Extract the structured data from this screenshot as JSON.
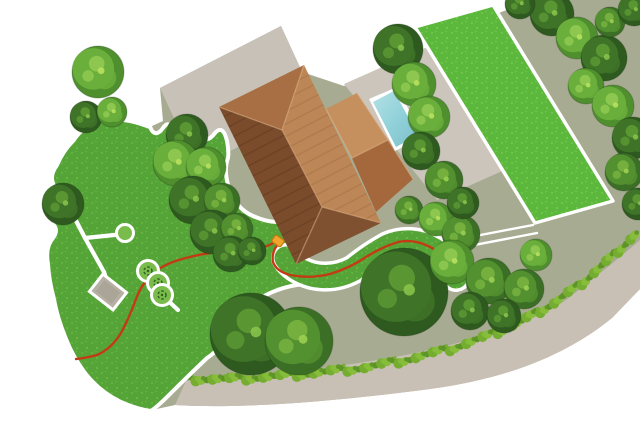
{
  "scene": {
    "kind": "garden-property-plan",
    "width": 640,
    "height": 427,
    "colors": {
      "background": "#ffffff",
      "ground": "#a7ab91",
      "road": "#c9c0b5",
      "driveway": "#c7c1b7",
      "patio": "#ccc5bb",
      "lawn": "#55a438",
      "lawn_dot1": "#70bb4c",
      "lawn_dot2": "#82c957",
      "rect_lawn": "#5cb83c",
      "rect_lawn_dot1": "#79d051",
      "rect_lawn_dot2": "#90dd63",
      "border": "#ffffff",
      "wire": "#c43a12",
      "station": "#f2a32d",
      "station_edge": "#c27b10",
      "pad": "#b6afa3",
      "pad_inner": "#a9a295",
      "bush_fill": "#7abc4b",
      "bush_mark": "#2f6021",
      "hedge": [
        "#5d9426",
        "#74ad30",
        "#86bd3a"
      ],
      "pool_frame": "#ffffff",
      "pool_water_light": "#b3e1e6",
      "pool_water_mid": "#8fd0d8",
      "pool_water_deep": "#7dbfca",
      "ridge_line": "#e0b488"
    },
    "tree_tones": {
      "dark": {
        "base": "#2e5a20",
        "mid": "#3f7428",
        "hi": "#5d9a33",
        "glow": "#86c24a"
      },
      "mid": {
        "base": "#3c6f26",
        "mid": "#539030",
        "hi": "#79b440",
        "glow": "#9ccf52"
      },
      "light": {
        "base": "#4f8f2e",
        "mid": "#6aaf3c",
        "hi": "#92ca52",
        "glow": "#b8e05e"
      }
    },
    "geometry": {
      "ground": "M 152 126 L 200 250 L 207 355 L 152 410 L 175 405 C 240 409 330 402 430 389 C 520 377 575 348 612 318 L 640 289 L 640 0 L 545 0 C 515 6 490 14 465 30 L 452 38 L 344 86 L 302 72 L 281 26 L 160 88 L 163 121 Z",
      "road": "M 175 405 C 240 409 330 402 430 389 C 520 377 575 348 612 318 L 640 289 L 640 240 C 622 256 600 273 570 297 C 536 323 470 341 420 352 C 350 367 260 376 186 381 Z",
      "driveway": "160,88 281,26 318,106 197,168",
      "patio": "344,84 452,36 545,152 437,200",
      "rect_lawn": "415,27 493,5 613,201 535,223",
      "left_lawn": "M 150 127 Q 155 139 163 128 Q 169 119 175 132 Q 180 143 188 130 Q 194 121 201 134 Q 206 145 215 133 Q 223 124 227 141 Q 229 152 228 158 Q 223 172 230 191 Q 237 209 253 216 Q 267 222 277 222 Q 288 225 290 237 Q 291 247 289 252 Q 288 261 298 268 Q 310 276 324 277 Q 338 280 341 287 Q 330 284 307 284 Q 286 285 266 295 Q 251 303 242 315 Q 235 327 225 341 Q 215 353 207 358 Q 186 378 168 396 Q 158 406 151 411 Q 136 409 119 401 Q 99 391 85 373 Q 73 357 66 339 Q 57 317 54 299 Q 49 281 48 264 Q 45 247 53 238 Q 60 229 50 221 Q 43 213 53 203 Q 60 196 55 187 Q 48 177 57 165 Q 63 151 73 141 Q 81 129 93 123 Q 105 117 117 119 Q 133 121 141 124 Z",
      "strip": "M 286 258 Q 294 270 312 275 Q 334 280 354 269 Q 370 256 388 246 Q 404 239 422 244 Q 438 250 448 261 Q 455 269 456 277",
      "wire_left": "M 277 241 Q 258 252 238 252 Q 212 251 190 257 Q 167 262 153 273 Q 142 283 136 299 Q 130 316 121 333 Q 111 349 97 355 Q 86 358 76 359",
      "wire_right": "M 279 243 Q 271 252 273 262 Q 276 271 290 275 Q 310 279 330 274 Q 350 268 366 257 Q 382 247 398 242 Q 414 239 428 246 Q 441 252 449 262 Q 455 269 456 277",
      "walkway": [
        [
          423,
          246,
          533,
          225
        ],
        [
          427,
          254,
          537,
          233
        ]
      ],
      "garden_paths": [
        [
          85,
          238,
          124,
          234
        ],
        [
          85,
          238,
          104,
          272
        ],
        [
          85,
          238,
          72,
          213
        ],
        [
          104,
          272,
          107,
          281
        ],
        [
          162,
          295,
          178,
          310
        ]
      ],
      "pad": {
        "cx": 108,
        "cy": 292,
        "w": 30,
        "h": 22,
        "angle": 38
      },
      "feature_circle": {
        "cx": 125,
        "cy": 233,
        "r": 8.5
      },
      "bushes": [
        [
          148,
          271,
          10.5
        ],
        [
          158,
          283,
          10.5
        ],
        [
          162,
          295,
          10.5
        ]
      ],
      "station": {
        "cx": 278,
        "cy": 241,
        "w": 11,
        "h": 8,
        "angle": 35
      },
      "pool_frame": "369,99 397,87 423,137 395,151",
      "pool_water": "373,102 394,91 418,135 396,147",
      "hedge_line": [
        [
          190,
          379
        ],
        [
          235,
          379
        ],
        [
          280,
          376
        ],
        [
          325,
          372
        ],
        [
          370,
          367
        ],
        [
          410,
          359
        ],
        [
          450,
          349
        ],
        [
          488,
          336
        ],
        [
          522,
          321
        ],
        [
          554,
          303
        ],
        [
          582,
          283
        ],
        [
          606,
          262
        ],
        [
          626,
          243
        ],
        [
          639,
          231
        ]
      ],
      "house_planes": [
        {
          "pts": "219,107 304,65 282,130",
          "fill": "#a96f44",
          "name": "roof-north-face"
        },
        {
          "pts": "304,65 381,223 322,207 282,130",
          "fill": "#bd8656",
          "name": "roof-east-face"
        },
        {
          "pts": "381,223 296,264 322,207",
          "fill": "#7f5130",
          "name": "roof-south-face"
        },
        {
          "pts": "296,264 219,107 282,130 322,207",
          "fill": "#7a4c2c",
          "name": "roof-west-face"
        },
        {
          "pts": "326,109 357,93 388,140 352,158",
          "fill": "#c68f5e",
          "name": "wing-north-face"
        },
        {
          "pts": "357,93 413,179 388,140",
          "fill": "#b57b4a",
          "name": "wing-end-face"
        },
        {
          "pts": "413,179 376,212 352,158 388,140",
          "fill": "#a4683c",
          "name": "wing-south-face"
        }
      ],
      "house_ridges": [
        [
          219,
          107,
          282,
          130
        ],
        [
          304,
          65,
          282,
          130
        ],
        [
          381,
          223,
          322,
          207
        ],
        [
          296,
          264,
          322,
          207
        ],
        [
          282,
          130,
          322,
          207
        ],
        [
          326,
          109,
          352,
          158
        ],
        [
          357,
          93,
          388,
          140
        ],
        [
          413,
          179,
          388,
          140
        ],
        [
          352,
          158,
          388,
          140
        ]
      ],
      "roof_stripes": [
        {
          "anchor": [
            219,
            107
          ],
          "clip": 3,
          "count": 16,
          "color": "rgba(35,15,5,0.16)"
        },
        {
          "anchor": [
            304,
            65
          ],
          "clip": 1,
          "count": 16,
          "color": "rgba(50,22,8,0.10)"
        }
      ],
      "trees": [
        [
          98,
          72,
          26,
          "light"
        ],
        [
          86,
          117,
          16,
          "dark"
        ],
        [
          112,
          112,
          15,
          "light"
        ],
        [
          63,
          204,
          21,
          "dark"
        ],
        [
          187,
          135,
          21,
          "dark"
        ],
        [
          176,
          163,
          23,
          "light"
        ],
        [
          206,
          167,
          20,
          "light"
        ],
        [
          193,
          200,
          24,
          "dark"
        ],
        [
          222,
          201,
          18,
          "mid"
        ],
        [
          212,
          232,
          22,
          "dark"
        ],
        [
          237,
          229,
          16,
          "mid"
        ],
        [
          231,
          254,
          18,
          "dark"
        ],
        [
          252,
          251,
          14,
          "dark"
        ],
        [
          251,
          334,
          41,
          "dark"
        ],
        [
          299,
          341,
          34,
          "mid"
        ],
        [
          404,
          292,
          44,
          "dark"
        ],
        [
          409,
          210,
          14,
          "mid"
        ],
        [
          436,
          219,
          17,
          "light"
        ],
        [
          461,
          234,
          19,
          "mid"
        ],
        [
          452,
          262,
          22,
          "light"
        ],
        [
          489,
          281,
          23,
          "mid"
        ],
        [
          524,
          289,
          20,
          "mid"
        ],
        [
          536,
          255,
          16,
          "light"
        ],
        [
          470,
          311,
          19,
          "dark"
        ],
        [
          504,
          316,
          17,
          "dark"
        ],
        [
          398,
          49,
          25,
          "dark"
        ],
        [
          414,
          84,
          22,
          "light"
        ],
        [
          429,
          117,
          21,
          "light"
        ],
        [
          421,
          151,
          19,
          "dark"
        ],
        [
          444,
          180,
          19,
          "mid"
        ],
        [
          463,
          203,
          16,
          "dark"
        ],
        [
          552,
          14,
          22,
          "dark"
        ],
        [
          577,
          38,
          21,
          "light"
        ],
        [
          604,
          58,
          23,
          "dark"
        ],
        [
          586,
          86,
          18,
          "light"
        ],
        [
          613,
          106,
          21,
          "light"
        ],
        [
          633,
          138,
          21,
          "dark"
        ],
        [
          624,
          172,
          19,
          "mid"
        ],
        [
          638,
          204,
          16,
          "dark"
        ],
        [
          610,
          22,
          15,
          "mid"
        ],
        [
          634,
          10,
          16,
          "dark"
        ],
        [
          520,
          4,
          15,
          "dark"
        ]
      ]
    }
  }
}
